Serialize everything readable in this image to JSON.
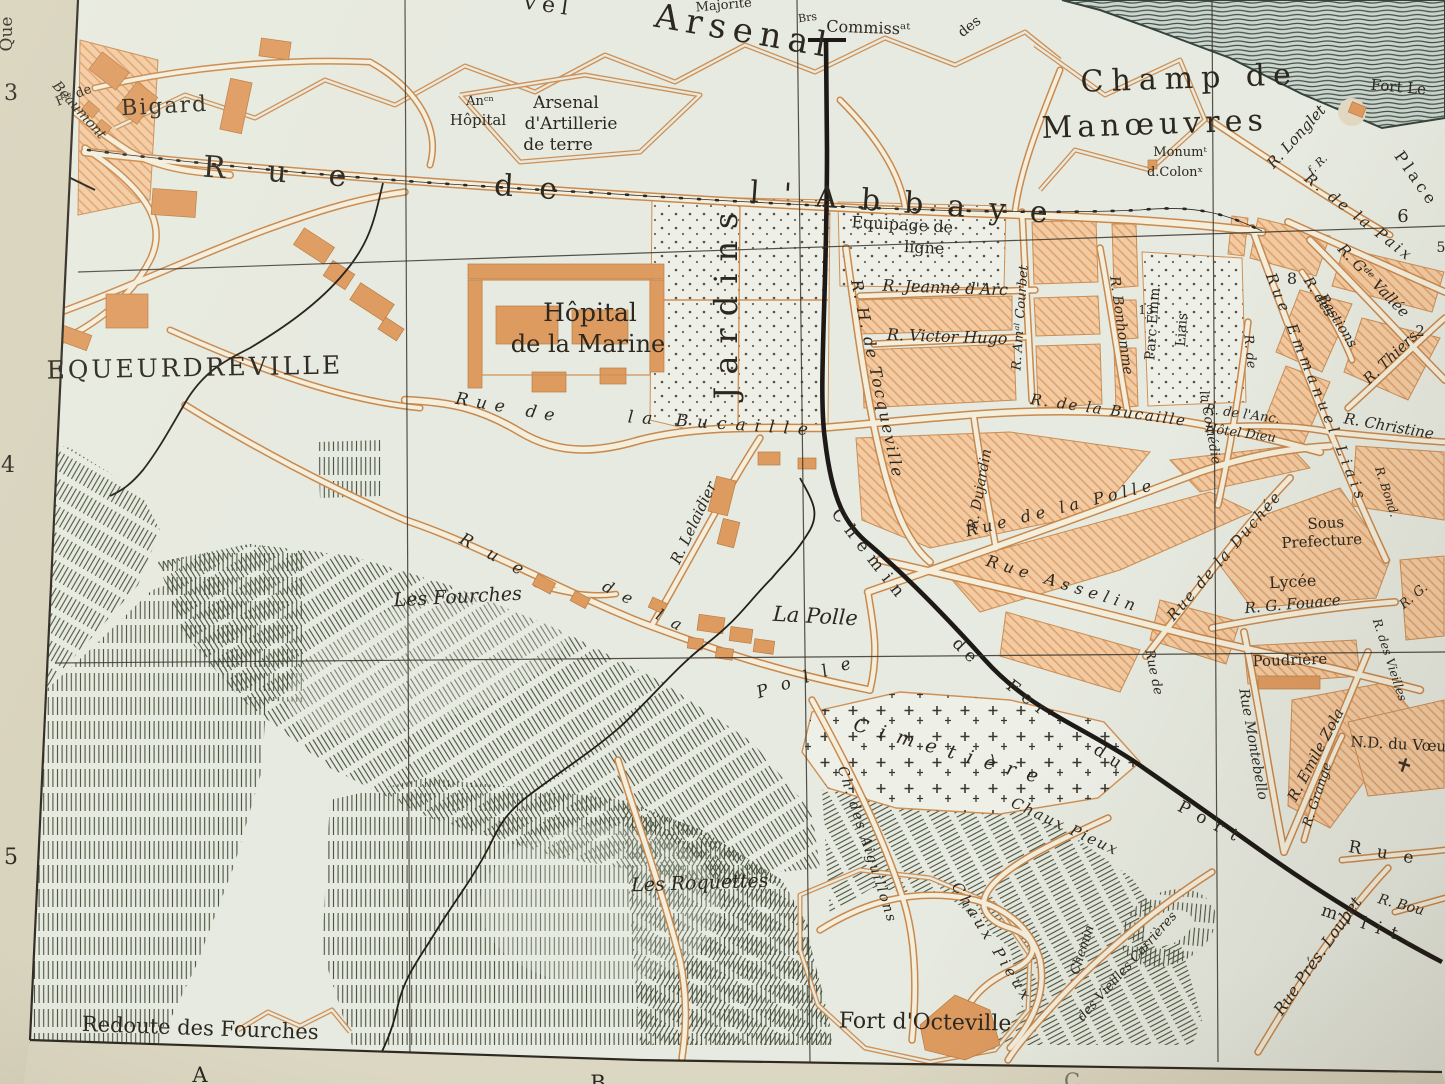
{
  "colors": {
    "paper_margin": "#d8d3bd",
    "map_background": "#e7eae0",
    "block_fill": "#f3cba2",
    "block_hatch_line": "#de9f6a",
    "building": "#dd9a60",
    "road_casing": "#c8894e",
    "road_fill": "#f4eedd",
    "ink": "#2c2820",
    "railway": "#1d1916",
    "hill_hachure": "#46503c",
    "contour_slope": "#3f5048"
  },
  "margins": {
    "left_numbers": [
      "3",
      "4",
      "5"
    ],
    "bottom_letters": [
      "A",
      "B",
      "C"
    ],
    "corner_text": "Que"
  },
  "labels": [
    {
      "id": "quai-margin",
      "text": "Que",
      "x": 12,
      "y": 34,
      "r": -90,
      "fs": 17,
      "cls": "roman"
    },
    {
      "id": "grid-num-3",
      "text": "3",
      "x": 11,
      "y": 100,
      "fs": 22,
      "cls": "roman"
    },
    {
      "id": "grid-num-4",
      "text": "4",
      "x": 8,
      "y": 472,
      "fs": 22,
      "cls": "roman"
    },
    {
      "id": "grid-num-5",
      "text": "5",
      "x": 11,
      "y": 864,
      "fs": 22,
      "cls": "roman"
    },
    {
      "id": "grid-letter-a",
      "text": "A",
      "x": 200,
      "y": 1082,
      "fs": 21,
      "cls": "roman"
    },
    {
      "id": "grid-letter-b",
      "text": "B",
      "x": 598,
      "y": 1090,
      "fs": 21,
      "cls": "roman"
    },
    {
      "id": "grid-letter-c",
      "text": "C",
      "x": 1072,
      "y": 1088,
      "fs": 21,
      "cls": "roman faint"
    },
    {
      "id": "nouvel-arsenal-frag",
      "text": "vel",
      "x": 548,
      "y": 12,
      "r": 8,
      "fs": 22,
      "ls": 6,
      "cls": "roman"
    },
    {
      "id": "arsenal",
      "text": "Arsenal",
      "x": 742,
      "y": 42,
      "r": 10,
      "fs": 34,
      "ls": 7,
      "cls": "roman"
    },
    {
      "id": "majorite",
      "text": "Majorité",
      "x": 724,
      "y": 9,
      "r": -5,
      "fs": 13,
      "cls": "roman"
    },
    {
      "id": "brs",
      "text": "Brs",
      "x": 808,
      "y": 21,
      "r": -8,
      "fs": 11,
      "cls": "roman"
    },
    {
      "id": "commissariat",
      "text": "Commissᵃᵗ",
      "x": 868,
      "y": 33,
      "r": 2,
      "fs": 16,
      "cls": "roman"
    },
    {
      "id": "des-frag",
      "text": "des",
      "x": 972,
      "y": 30,
      "r": -38,
      "fs": 14,
      "cls": "roman"
    },
    {
      "id": "champ-de",
      "text": "Champ de",
      "x": 1190,
      "y": 88,
      "r": -2,
      "fs": 30,
      "ls": 8,
      "cls": "roman"
    },
    {
      "id": "manoeuvres",
      "text": "Manœuvres",
      "x": 1155,
      "y": 134,
      "r": -2,
      "fs": 30,
      "ls": 5,
      "cls": "roman"
    },
    {
      "id": "monument",
      "text": "Monumᵗ",
      "x": 1180,
      "y": 156,
      "fs": 13,
      "cls": "roman"
    },
    {
      "id": "colonnes",
      "text": "d.Colonˣ",
      "x": 1175,
      "y": 176,
      "fs": 13,
      "cls": "roman"
    },
    {
      "id": "fort-le",
      "text": "Fort Le",
      "x": 1398,
      "y": 92,
      "r": 5,
      "fs": 15,
      "cls": "roman"
    },
    {
      "id": "place",
      "text": "Place",
      "x": 1412,
      "y": 182,
      "r": 55,
      "fs": 16,
      "ls": 4,
      "cls": "roman"
    },
    {
      "id": "r-longlet",
      "text": "R. Longlet",
      "x": 1300,
      "y": 140,
      "r": -48,
      "fs": 15,
      "cls": "ital"
    },
    {
      "id": "f-r",
      "text": "f. R.",
      "x": 1320,
      "y": 167,
      "r": -45,
      "fs": 11,
      "cls": "ital"
    },
    {
      "id": "r-de-la-paix",
      "text": "R. de la Paix",
      "x": 1356,
      "y": 221,
      "r": 38,
      "fs": 15,
      "ls": 3,
      "cls": "ital"
    },
    {
      "id": "blocknum-6",
      "text": "6",
      "x": 1403,
      "y": 222,
      "fs": 18,
      "cls": "roman"
    },
    {
      "id": "blocknum-5",
      "text": "5",
      "x": 1441,
      "y": 252,
      "fs": 14,
      "cls": "roman"
    },
    {
      "id": "r-gde-vallee",
      "text": "R. Gᵈᵉ Vallée",
      "x": 1370,
      "y": 284,
      "r": 46,
      "fs": 15,
      "cls": "ital"
    },
    {
      "id": "blocknum-8",
      "text": "8",
      "x": 1292,
      "y": 284,
      "fs": 16,
      "cls": "roman"
    },
    {
      "id": "r-des-bastions-1",
      "text": "R. des",
      "x": 1315,
      "y": 299,
      "r": 58,
      "fs": 14,
      "cls": "ital"
    },
    {
      "id": "r-des-bastions-2",
      "text": "Bastions",
      "x": 1334,
      "y": 323,
      "r": 58,
      "fs": 14,
      "cls": "ital"
    },
    {
      "id": "blocknum-2",
      "text": "2",
      "x": 1420,
      "y": 336,
      "fs": 15,
      "cls": "roman"
    },
    {
      "id": "r-thiers",
      "text": "R. Thiers",
      "x": 1394,
      "y": 361,
      "r": -44,
      "fs": 15,
      "cls": "ital"
    },
    {
      "id": "r-christine",
      "text": "R. Christine",
      "x": 1388,
      "y": 431,
      "r": 10,
      "fs": 15,
      "cls": "ital"
    },
    {
      "id": "r-anc-hotel-dieu-1",
      "text": "R. de l'Anc.",
      "x": 1242,
      "y": 418,
      "r": 8,
      "fs": 13,
      "cls": "ital"
    },
    {
      "id": "r-anc-hotel-dieu-2",
      "text": "Hôtel Dieu",
      "x": 1240,
      "y": 437,
      "r": 8,
      "fs": 13,
      "cls": "ital"
    },
    {
      "id": "rue-emmanuel-liais",
      "text": "Rue Emmanuel Liais",
      "x": 1312,
      "y": 390,
      "r": 68,
      "fs": 15,
      "ls": 5,
      "cls": "ital"
    },
    {
      "id": "parc-emm",
      "text": "Parc Emm.",
      "x": 1157,
      "y": 322,
      "r": -86,
      "fs": 14,
      "cls": "roman"
    },
    {
      "id": "parc-liais",
      "text": "Liais",
      "x": 1186,
      "y": 330,
      "r": -86,
      "fs": 14,
      "cls": "roman"
    },
    {
      "id": "blocknum-13",
      "text": "13",
      "x": 1146,
      "y": 314,
      "fs": 12,
      "cls": "roman"
    },
    {
      "id": "r-comedie-1",
      "text": "R. de",
      "x": 1246,
      "y": 352,
      "r": 84,
      "fs": 13,
      "cls": "ital"
    },
    {
      "id": "r-comedie-2",
      "text": "la Comédie",
      "x": 1206,
      "y": 428,
      "r": 80,
      "fs": 13,
      "cls": "ital"
    },
    {
      "id": "r-bonhomme",
      "text": "R. Bonhomme",
      "x": 1117,
      "y": 326,
      "r": 82,
      "fs": 14,
      "cls": "ital"
    },
    {
      "id": "r-amiral-courbet",
      "text": "R. Amᵃˡ Courbet",
      "x": 1024,
      "y": 318,
      "r": -86,
      "fs": 13,
      "cls": "ital"
    },
    {
      "id": "equipage-1",
      "text": "Equipage de",
      "x": 902,
      "y": 230,
      "r": 3,
      "fs": 16,
      "cls": "roman"
    },
    {
      "id": "equipage-2",
      "text": "ligne",
      "x": 924,
      "y": 253,
      "r": 3,
      "fs": 16,
      "cls": "roman"
    },
    {
      "id": "r-jeanne-darc",
      "text": "R. Jeanne d'Arc",
      "x": 945,
      "y": 293,
      "r": 2,
      "fs": 16,
      "cls": "ital"
    },
    {
      "id": "r-victor-hugo",
      "text": "R. Victor Hugo",
      "x": 947,
      "y": 342,
      "r": 2,
      "fs": 16,
      "cls": "ital"
    },
    {
      "id": "r-tocqueville",
      "text": "R. H. de Tocqueville",
      "x": 872,
      "y": 380,
      "r": 78,
      "fs": 16,
      "ls": 2,
      "cls": "ital"
    },
    {
      "id": "r-dujardin",
      "text": "R. Dujardin",
      "x": 984,
      "y": 490,
      "r": -80,
      "fs": 14,
      "cls": "ital"
    },
    {
      "id": "rue-abbaye-1",
      "text": "Rue",
      "x": 295,
      "y": 183,
      "r": 4,
      "fs": 30,
      "ls": 42,
      "cls": "roman"
    },
    {
      "id": "rue-abbaye-2",
      "text": "de",
      "x": 538,
      "y": 198,
      "r": 4,
      "fs": 30,
      "ls": 26,
      "cls": "roman"
    },
    {
      "id": "rue-abbaye-3",
      "text": "l'Abbaye",
      "x": 910,
      "y": 213,
      "r": 4,
      "fs": 30,
      "ls": 24,
      "cls": "roman"
    },
    {
      "id": "rue-bucaille-1",
      "text": "Rue de",
      "x": 508,
      "y": 413,
      "r": 10,
      "fs": 17,
      "ls": 8,
      "cls": "ital"
    },
    {
      "id": "rue-bucaille-2",
      "text": "la Bucaille",
      "x": 722,
      "y": 429,
      "r": 4,
      "fs": 17,
      "ls": 9,
      "cls": "ital"
    },
    {
      "id": "r-bucaille-east",
      "text": "R. de la Bucaille",
      "x": 1108,
      "y": 415,
      "r": 8,
      "fs": 15,
      "ls": 2,
      "cls": "ital"
    },
    {
      "id": "hopital-marine-1",
      "text": "Hôpital",
      "x": 590,
      "y": 321,
      "fs": 25,
      "cls": "roman"
    },
    {
      "id": "hopital-marine-2",
      "text": "de la Marine",
      "x": 588,
      "y": 352,
      "fs": 24,
      "cls": "roman"
    },
    {
      "id": "jardins",
      "text": "Jardins",
      "x": 737,
      "y": 300,
      "r": -90,
      "fs": 32,
      "ls": 12,
      "cls": "roman"
    },
    {
      "id": "equeurdreville",
      "text": "EQUEURDREVILLE",
      "x": 195,
      "y": 376,
      "r": -1,
      "fs": 25,
      "ls": 3,
      "cls": "roman"
    },
    {
      "id": "fte-de",
      "text": "Fᵗᵉ de",
      "x": 75,
      "y": 99,
      "r": -22,
      "fs": 13,
      "cls": "ro…man"
    },
    {
      "id": "bigard",
      "text": "Bigard",
      "x": 165,
      "y": 113,
      "r": -3,
      "fs": 22,
      "ls": 2,
      "cls": "roman"
    },
    {
      "id": "beaumont",
      "text": "Beaumont",
      "x": 76,
      "y": 113,
      "r": 48,
      "fs": 14,
      "cls": "ital"
    },
    {
      "id": "rue-polle-1",
      "text": "Rue",
      "x": 497,
      "y": 563,
      "r": 28,
      "fs": 17,
      "ls": 18,
      "cls": "ital"
    },
    {
      "id": "rue-polle-2",
      "text": "de la",
      "x": 645,
      "y": 613,
      "r": 28,
      "fs": 16,
      "ls": 12,
      "cls": "ital"
    },
    {
      "id": "rue-polle-3",
      "text": "Polle",
      "x": 812,
      "y": 681,
      "r": -18,
      "fs": 17,
      "ls": 14,
      "cls": "ital"
    },
    {
      "id": "rue-polle-city",
      "text": "Rue de la Polle",
      "x": 1062,
      "y": 513,
      "r": -14,
      "fs": 16,
      "ls": 5,
      "cls": "ital"
    },
    {
      "id": "rue-asselin",
      "text": "Rue Asselin",
      "x": 1062,
      "y": 589,
      "r": 17,
      "fs": 16,
      "ls": 6,
      "cls": "ital"
    },
    {
      "id": "rue-duchee",
      "text": "Rue de la Duchée",
      "x": 1228,
      "y": 559,
      "r": -49,
      "fs": 15,
      "ls": 2,
      "cls": "ital"
    },
    {
      "id": "sous-prefecture-1",
      "text": "Sous",
      "x": 1326,
      "y": 528,
      "r": -3,
      "fs": 15,
      "cls": "roman"
    },
    {
      "id": "sous-prefecture-2",
      "text": "Prefecture",
      "x": 1322,
      "y": 546,
      "r": -3,
      "fs": 15,
      "cls": "roman"
    },
    {
      "id": "lycee",
      "text": "Lycée",
      "x": 1293,
      "y": 587,
      "r": -3,
      "fs": 16,
      "cls": "roman"
    },
    {
      "id": "r-g-fouace",
      "text": "R. G. Fouace",
      "x": 1293,
      "y": 609,
      "r": -5,
      "fs": 15,
      "cls": "ital"
    },
    {
      "id": "poudriere",
      "text": "Poudrière",
      "x": 1290,
      "y": 665,
      "r": -2,
      "fs": 15,
      "cls": "roman"
    },
    {
      "id": "rue-montebello",
      "text": "Rue Montebello",
      "x": 1249,
      "y": 745,
      "r": 80,
      "fs": 14,
      "cls": "ital"
    },
    {
      "id": "r-emile-zola",
      "text": "R. Emile Zola",
      "x": 1320,
      "y": 757,
      "r": -62,
      "fs": 15,
      "cls": "ital"
    },
    {
      "id": "r-grange",
      "text": "R. Grange",
      "x": 1321,
      "y": 796,
      "r": -72,
      "fs": 13,
      "cls": "ital"
    },
    {
      "id": "r-des-vieilles",
      "text": "R. des Vieilles",
      "x": 1386,
      "y": 661,
      "r": 72,
      "fs": 12,
      "cls": "ital"
    },
    {
      "id": "r-bond",
      "text": "R. Bond.",
      "x": 1383,
      "y": 493,
      "r": 72,
      "fs": 12,
      "cls": "ital"
    },
    {
      "id": "nd-du-voeu",
      "text": "N.D. du Vœu",
      "x": 1398,
      "y": 749,
      "r": 3,
      "fs": 15,
      "cls": "roman"
    },
    {
      "id": "r-g-frag",
      "text": "R. G.",
      "x": 1416,
      "y": 599,
      "r": -40,
      "fs": 13,
      "cls": "ital"
    },
    {
      "id": "rue-frag",
      "text": "Rue",
      "x": 1388,
      "y": 859,
      "r": 10,
      "fs": 17,
      "ls": 16,
      "cls": "roman"
    },
    {
      "id": "r-bou-frag",
      "text": "R. Bou",
      "x": 1400,
      "y": 909,
      "r": 15,
      "fs": 14,
      "cls": "ital"
    },
    {
      "id": "chemin-fer-1",
      "text": "Chemin",
      "x": 866,
      "y": 559,
      "r": 52,
      "fs": 17,
      "ls": 8,
      "cls": "roman"
    },
    {
      "id": "chemin-fer-2",
      "text": "de",
      "x": 963,
      "y": 656,
      "r": 45,
      "fs": 17,
      "ls": 6,
      "cls": "roman"
    },
    {
      "id": "chemin-fer-3",
      "text": "Fer",
      "x": 1026,
      "y": 704,
      "r": 38,
      "fs": 17,
      "ls": 8,
      "cls": "roman"
    },
    {
      "id": "chemin-fer-4",
      "text": "du",
      "x": 1108,
      "y": 763,
      "r": 34,
      "fs": 17,
      "ls": 8,
      "cls": "roman"
    },
    {
      "id": "chemin-fer-5",
      "text": "Port",
      "x": 1210,
      "y": 828,
      "r": 28,
      "fs": 17,
      "ls": 10,
      "cls": "roman"
    },
    {
      "id": "chemin-fer-6",
      "text": "milit.",
      "x": 1370,
      "y": 931,
      "r": 18,
      "fs": 17,
      "ls": 10,
      "cls": "roman"
    },
    {
      "id": "la-polle",
      "text": "La Polle",
      "x": 815,
      "y": 623,
      "r": 3,
      "fs": 21,
      "cls": "ital"
    },
    {
      "id": "cimetiere",
      "text": "Cimetière",
      "x": 950,
      "y": 758,
      "r": 16,
      "fs": 19,
      "ls": 12,
      "cls": "ital"
    },
    {
      "id": "chaux-pieux-1",
      "text": "Chaux Pieux",
      "x": 1063,
      "y": 831,
      "r": 25,
      "fs": 15,
      "ls": 2,
      "cls": "ital"
    },
    {
      "id": "chaux-pieux-2",
      "text": "Chaux Pieux",
      "x": 988,
      "y": 945,
      "r": 58,
      "fs": 15,
      "ls": 4,
      "cls": "ital"
    },
    {
      "id": "chemin-carrieres-1",
      "text": "Chemin",
      "x": 1086,
      "y": 951,
      "r": -72,
      "fs": 13,
      "cls": "ital"
    },
    {
      "id": "chemin-carrieres-2",
      "text": "des Vieilles Carrières",
      "x": 1130,
      "y": 969,
      "r": -48,
      "fs": 13,
      "cls": "ital"
    },
    {
      "id": "ch-aiguillons",
      "text": "Ch. des Aiguillons",
      "x": 863,
      "y": 846,
      "r": 72,
      "fs": 14,
      "ls": 2,
      "cls": "ital"
    },
    {
      "id": "r-lelaidier",
      "text": "R. Lelaidier",
      "x": 698,
      "y": 525,
      "r": -65,
      "fs": 15,
      "cls": "ital"
    },
    {
      "id": "les-fourches",
      "text": "Les Fourches",
      "x": 458,
      "y": 603,
      "r": -3,
      "fs": 19,
      "cls": "ital"
    },
    {
      "id": "les-roquettes",
      "text": "Les Roquettes",
      "x": 700,
      "y": 889,
      "r": -2,
      "fs": 19,
      "cls": "ital"
    },
    {
      "id": "redoute-des-fourches",
      "text": "Redoute des Fourches",
      "x": 200,
      "y": 1035,
      "r": 2,
      "fs": 21,
      "cls": "roman"
    },
    {
      "id": "fort-octeville",
      "text": "Fort d'Octeville",
      "x": 925,
      "y": 1029,
      "r": 1,
      "fs": 22,
      "cls": "roman"
    },
    {
      "id": "rue-pres-loubet",
      "text": "Rue Prés. Loubet",
      "x": 1322,
      "y": 959,
      "r": -55,
      "fs": 16,
      "cls": "ital"
    },
    {
      "id": "ancien-hopital-1",
      "text": "Anᶜⁿ",
      "x": 480,
      "y": 105,
      "fs": 13,
      "cls": "roman"
    },
    {
      "id": "ancien-hopital-2",
      "text": "Hôpital",
      "x": 478,
      "y": 125,
      "fs": 15,
      "cls": "roman"
    },
    {
      "id": "arsenal-artillerie-1",
      "text": "Arsenal",
      "x": 566,
      "y": 108,
      "fs": 17,
      "cls": "roman"
    },
    {
      "id": "arsenal-artillerie-2",
      "text": "d'Artillerie",
      "x": 571,
      "y": 129,
      "fs": 17,
      "cls": "roman"
    },
    {
      "id": "arsenal-artillerie-3",
      "text": "de terre",
      "x": 558,
      "y": 150,
      "fs": 17,
      "cls": "roman"
    },
    {
      "id": "rue-de-frag",
      "text": "Rue de",
      "x": 1150,
      "y": 673,
      "r": 78,
      "fs": 13,
      "cls": "ital"
    }
  ]
}
